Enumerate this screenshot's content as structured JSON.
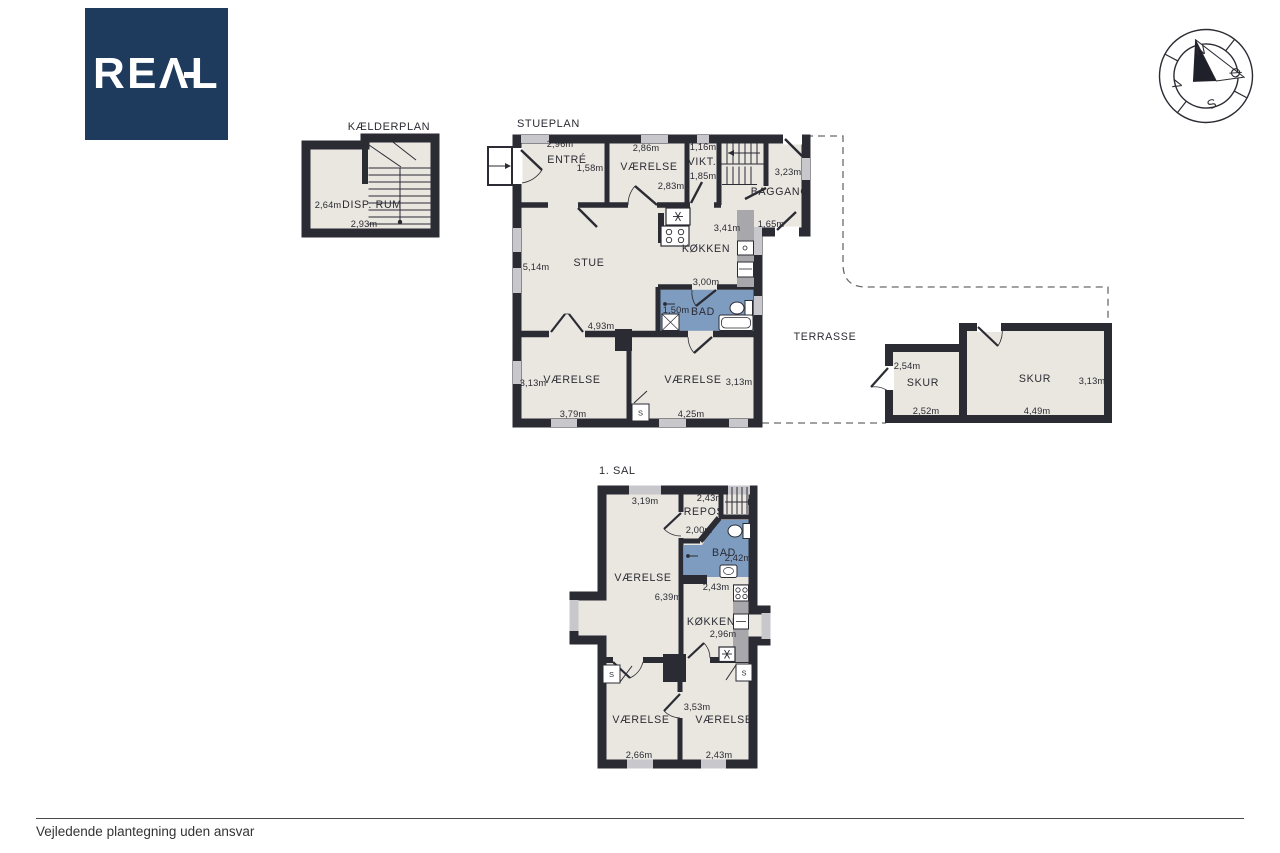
{
  "brand": {
    "logo_text": "REAL",
    "logo_bg": "#1e3a5c"
  },
  "compass": {
    "n": "N",
    "e": "Ø",
    "s": "S",
    "w": "V"
  },
  "colors": {
    "wall": "#2b2b33",
    "floor": "#eae6e0",
    "bath": "#7e9cc0",
    "window": "#c8c8cc",
    "counter": "#a8a8ac"
  },
  "kaelderplan": {
    "title": "KÆLDERPLAN",
    "disp_rum": {
      "name": "DISP. RUM",
      "width": "2,64m",
      "length": "2,93m"
    }
  },
  "stueplan": {
    "title": "STUEPLAN",
    "entre": {
      "name": "ENTRÉ",
      "dim_top": "2,96m",
      "dim_side": "1,58m"
    },
    "vaerelse_top": {
      "name": "VÆRELSE",
      "dim_top": "2,86m",
      "dim_bottom": "2,83m"
    },
    "vikt": {
      "name": "VIKT.",
      "dim_top": "1,16m",
      "dim_side": "1,85m"
    },
    "baggang": {
      "name": "BAGGANG",
      "dim_side": "3,23m",
      "dim_door": "1,65m"
    },
    "koekken": {
      "name": "KØKKEN",
      "dim_side": "3,41m",
      "dim_bottom": "3,00m"
    },
    "stue": {
      "name": "STUE",
      "dim_side": "5,14m",
      "dim_bottom": "4,93m"
    },
    "bad": {
      "name": "BAD",
      "dim": "1,50m"
    },
    "vaerelse_left": {
      "name": "VÆRELSE",
      "dim_side": "3,13m",
      "dim_bottom": "3,79m"
    },
    "vaerelse_right": {
      "name": "VÆRELSE",
      "dim_side": "3,13m",
      "dim_bottom": "4,25m"
    },
    "closet": "S",
    "terrasse": "TERRASSE",
    "skur_left": {
      "name": "SKUR",
      "dim_side": "2,54m",
      "dim_bottom": "2,52m"
    },
    "skur_right": {
      "name": "SKUR",
      "dim_side": "3,13m",
      "dim_bottom": "4,49m"
    }
  },
  "foerste_sal": {
    "title": "1. SAL",
    "vaerelse": {
      "name": "VÆRELSE",
      "dim_top": "3,19m",
      "dim_side": "6,39m"
    },
    "repos": {
      "name": "REPOS",
      "dim_top": "2,43m",
      "dim": "2,00m"
    },
    "bad": {
      "name": "BAD",
      "dim": "2,42m"
    },
    "koekken": {
      "name": "KØKKEN",
      "dim_top": "2,43m",
      "dim_side": "2,96m"
    },
    "vaerelse_bl": {
      "name": "VÆRELSE",
      "dim_bottom": "2,66m"
    },
    "vaerelse_br": {
      "name": "VÆRELSE",
      "dim_side": "3,53m",
      "dim_bottom": "2,43m"
    },
    "closet": "S"
  },
  "footer": {
    "disclaimer": "Vejledende plantegning uden ansvar"
  }
}
